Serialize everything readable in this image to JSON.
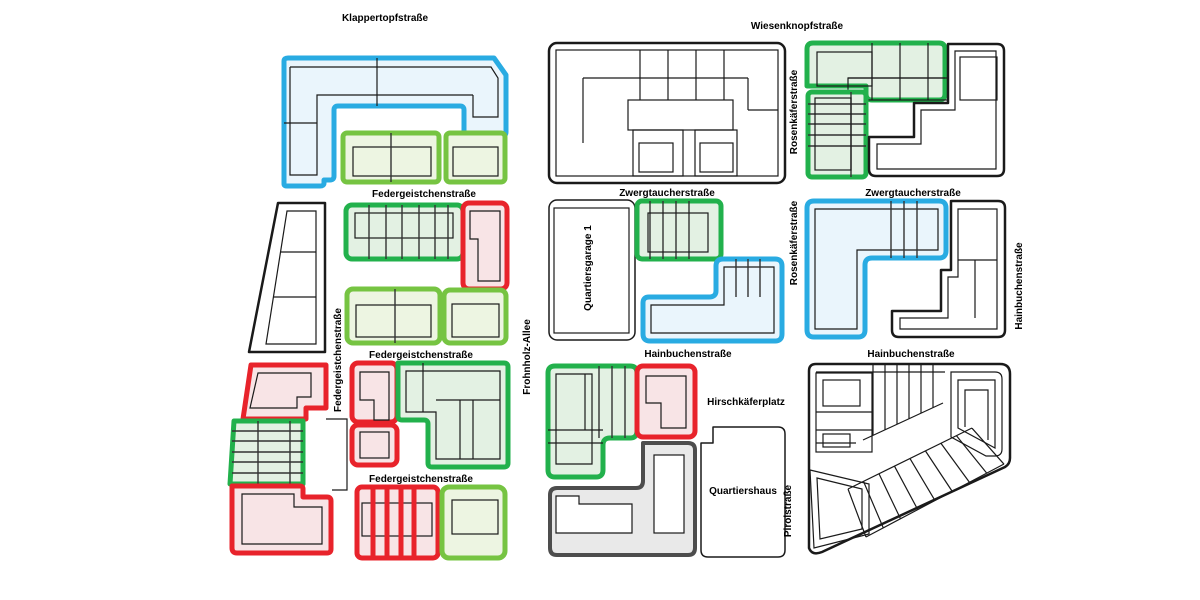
{
  "plan": {
    "type": "urban-quarter-site-plan",
    "colors": {
      "outline_blue": "#29ABE2",
      "fill_blue": "#EAF5FC",
      "outline_green": "#22B14C",
      "fill_green": "#E3F1E3",
      "outline_lightgreen": "#76C442",
      "fill_lightgreen": "#EDF5E2",
      "outline_red": "#E8232B",
      "fill_red": "#F8E4E6",
      "outline_black": "#1A1A1A",
      "outline_gray": "#4D4D4D",
      "fill_gray": "#E9E9E9"
    }
  },
  "streets": {
    "klappertopfstrasse": "Klappertopfstraße",
    "wiesenknopfstrasse": "Wiesenknopfstraße",
    "federgeistchenstrasse": "Federgeistchenstraße",
    "zwergtaucherstrasse": "Zwergtaucherstraße",
    "hainbuchenstrasse": "Hainbuchenstraße",
    "rosenkaeferstrasse": "Rosenkäferstraße",
    "frohnholz_allee": "Frohnholz-Allee",
    "pirolstrasse": "Pirolstraße",
    "hirschkaeferplatz": "Hirschkäferplatz"
  },
  "buildings": {
    "quartiersgarage": "Quartiersgarage 1",
    "quartiershaus": "Quartiershaus"
  }
}
